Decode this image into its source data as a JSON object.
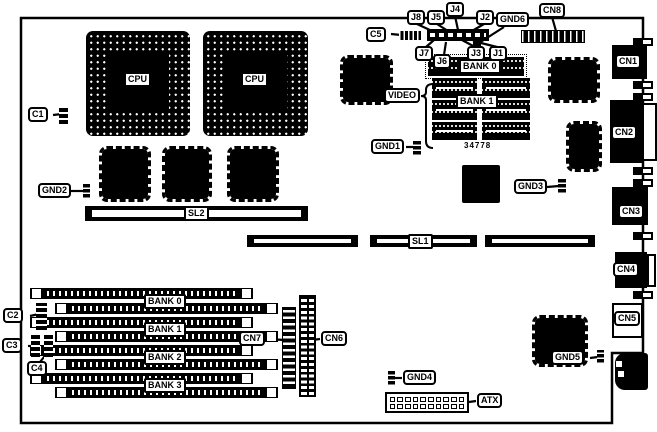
{
  "colors": {
    "ink": "#000000",
    "paper": "#ffffff"
  },
  "cpus": {
    "cpu1": "CPU",
    "cpu2": "CPU"
  },
  "slots": {
    "sl1": "SL1",
    "sl2": "SL2"
  },
  "memory": {
    "bank0": "BANK 0",
    "bank1": "BANK 1",
    "video": "VIDEO",
    "part_number": "34778",
    "simm": {
      "bank0": "BANK 0",
      "bank1": "BANK 1",
      "bank2": "BANK 2",
      "bank3": "BANK 3"
    }
  },
  "connectors": {
    "cn1": "CN1",
    "cn2": "CN2",
    "cn3": "CN3",
    "cn4": "CN4",
    "cn5": "CN5",
    "cn6": "CN6",
    "cn7": "CN7",
    "cn8": "CN8",
    "atx": "ATX"
  },
  "jumpers": {
    "j1": "J1",
    "j2": "J2",
    "j3": "J3",
    "j4": "J4",
    "j5": "J5",
    "j6": "J6",
    "j7": "J7",
    "j8": "J8"
  },
  "grounds": {
    "gnd1": "GND1",
    "gnd2": "GND2",
    "gnd3": "GND3",
    "gnd4": "GND4",
    "gnd5": "GND5",
    "gnd6": "GND6"
  },
  "capacitors": {
    "c1": "C1",
    "c2": "C2",
    "c3": "C3",
    "c4": "C4",
    "c5": "C5"
  }
}
